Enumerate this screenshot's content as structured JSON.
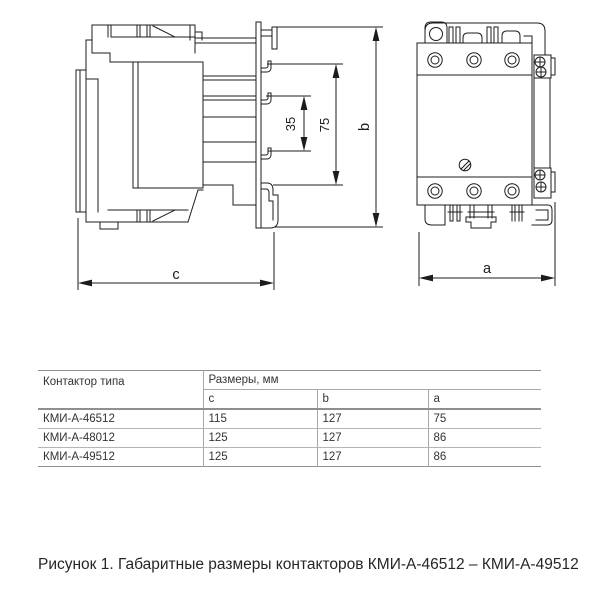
{
  "figure": {
    "labels": {
      "l35": "35",
      "l75": "75",
      "b": "b",
      "c": "c",
      "a": "a"
    }
  },
  "table": {
    "type_header": "Контактор типа",
    "size_header": "Размеры, мм",
    "cols": [
      "c",
      "b",
      "a"
    ],
    "rows": [
      {
        "model": "КМИ-А-46512",
        "c": "115",
        "b": "127",
        "a": "75"
      },
      {
        "model": "КМИ-А-48012",
        "c": "125",
        "b": "127",
        "a": "86"
      },
      {
        "model": "КМИ-А-49512",
        "c": "125",
        "b": "127",
        "a": "86"
      }
    ]
  },
  "caption": "Рисунок 1. Габаритные размеры контакторов КМИ-А-46512 – КМИ-А-49512",
  "colors": {
    "line": "#1c1c1c",
    "table_border": "#8f8f8f",
    "text": "#333333"
  }
}
